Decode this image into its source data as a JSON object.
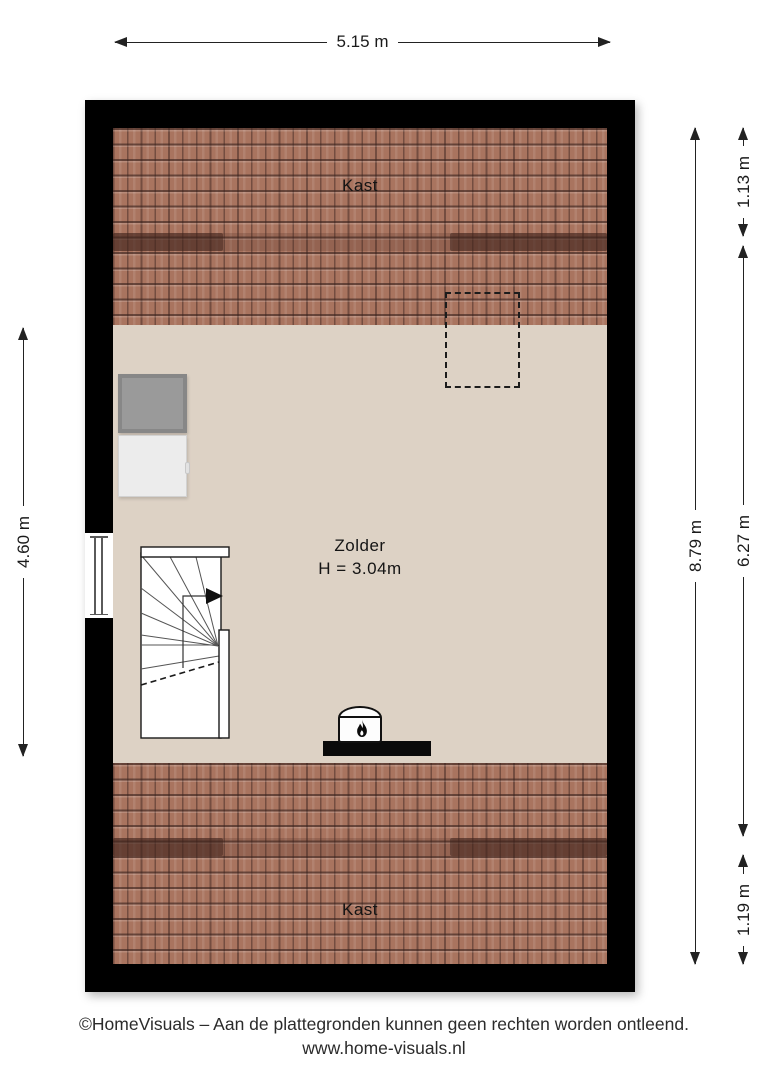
{
  "plan": {
    "rooms": {
      "kast_top": "Kast",
      "zolder": "Zolder",
      "zolder_height": "H = 3.04m",
      "kast_bottom": "Kast"
    },
    "dimensions": {
      "top_width": "5.15 m",
      "left_height": "4.60 m",
      "right_total_height": "8.79 m",
      "right_top_segment": "1.13 m",
      "right_middle_segment": "6.27 m",
      "right_bottom_segment": "1.19 m"
    },
    "colors": {
      "wall": "#000000",
      "floor": "#ddd2c5",
      "roof_tile": "#a9745f",
      "roof_knee_band": "#5e3a30",
      "appliance_dark": "#9a9a9a",
      "appliance_light": "#ececec",
      "dimension_line": "#222222"
    },
    "icons": {
      "stove": "flame-icon",
      "stairs_direction": "stairs-up-arrow-icon"
    }
  },
  "footer": {
    "line1": "©HomeVisuals – Aan de plattegronden kunnen geen rechten worden ontleend.",
    "line2": "www.home-visuals.nl"
  }
}
